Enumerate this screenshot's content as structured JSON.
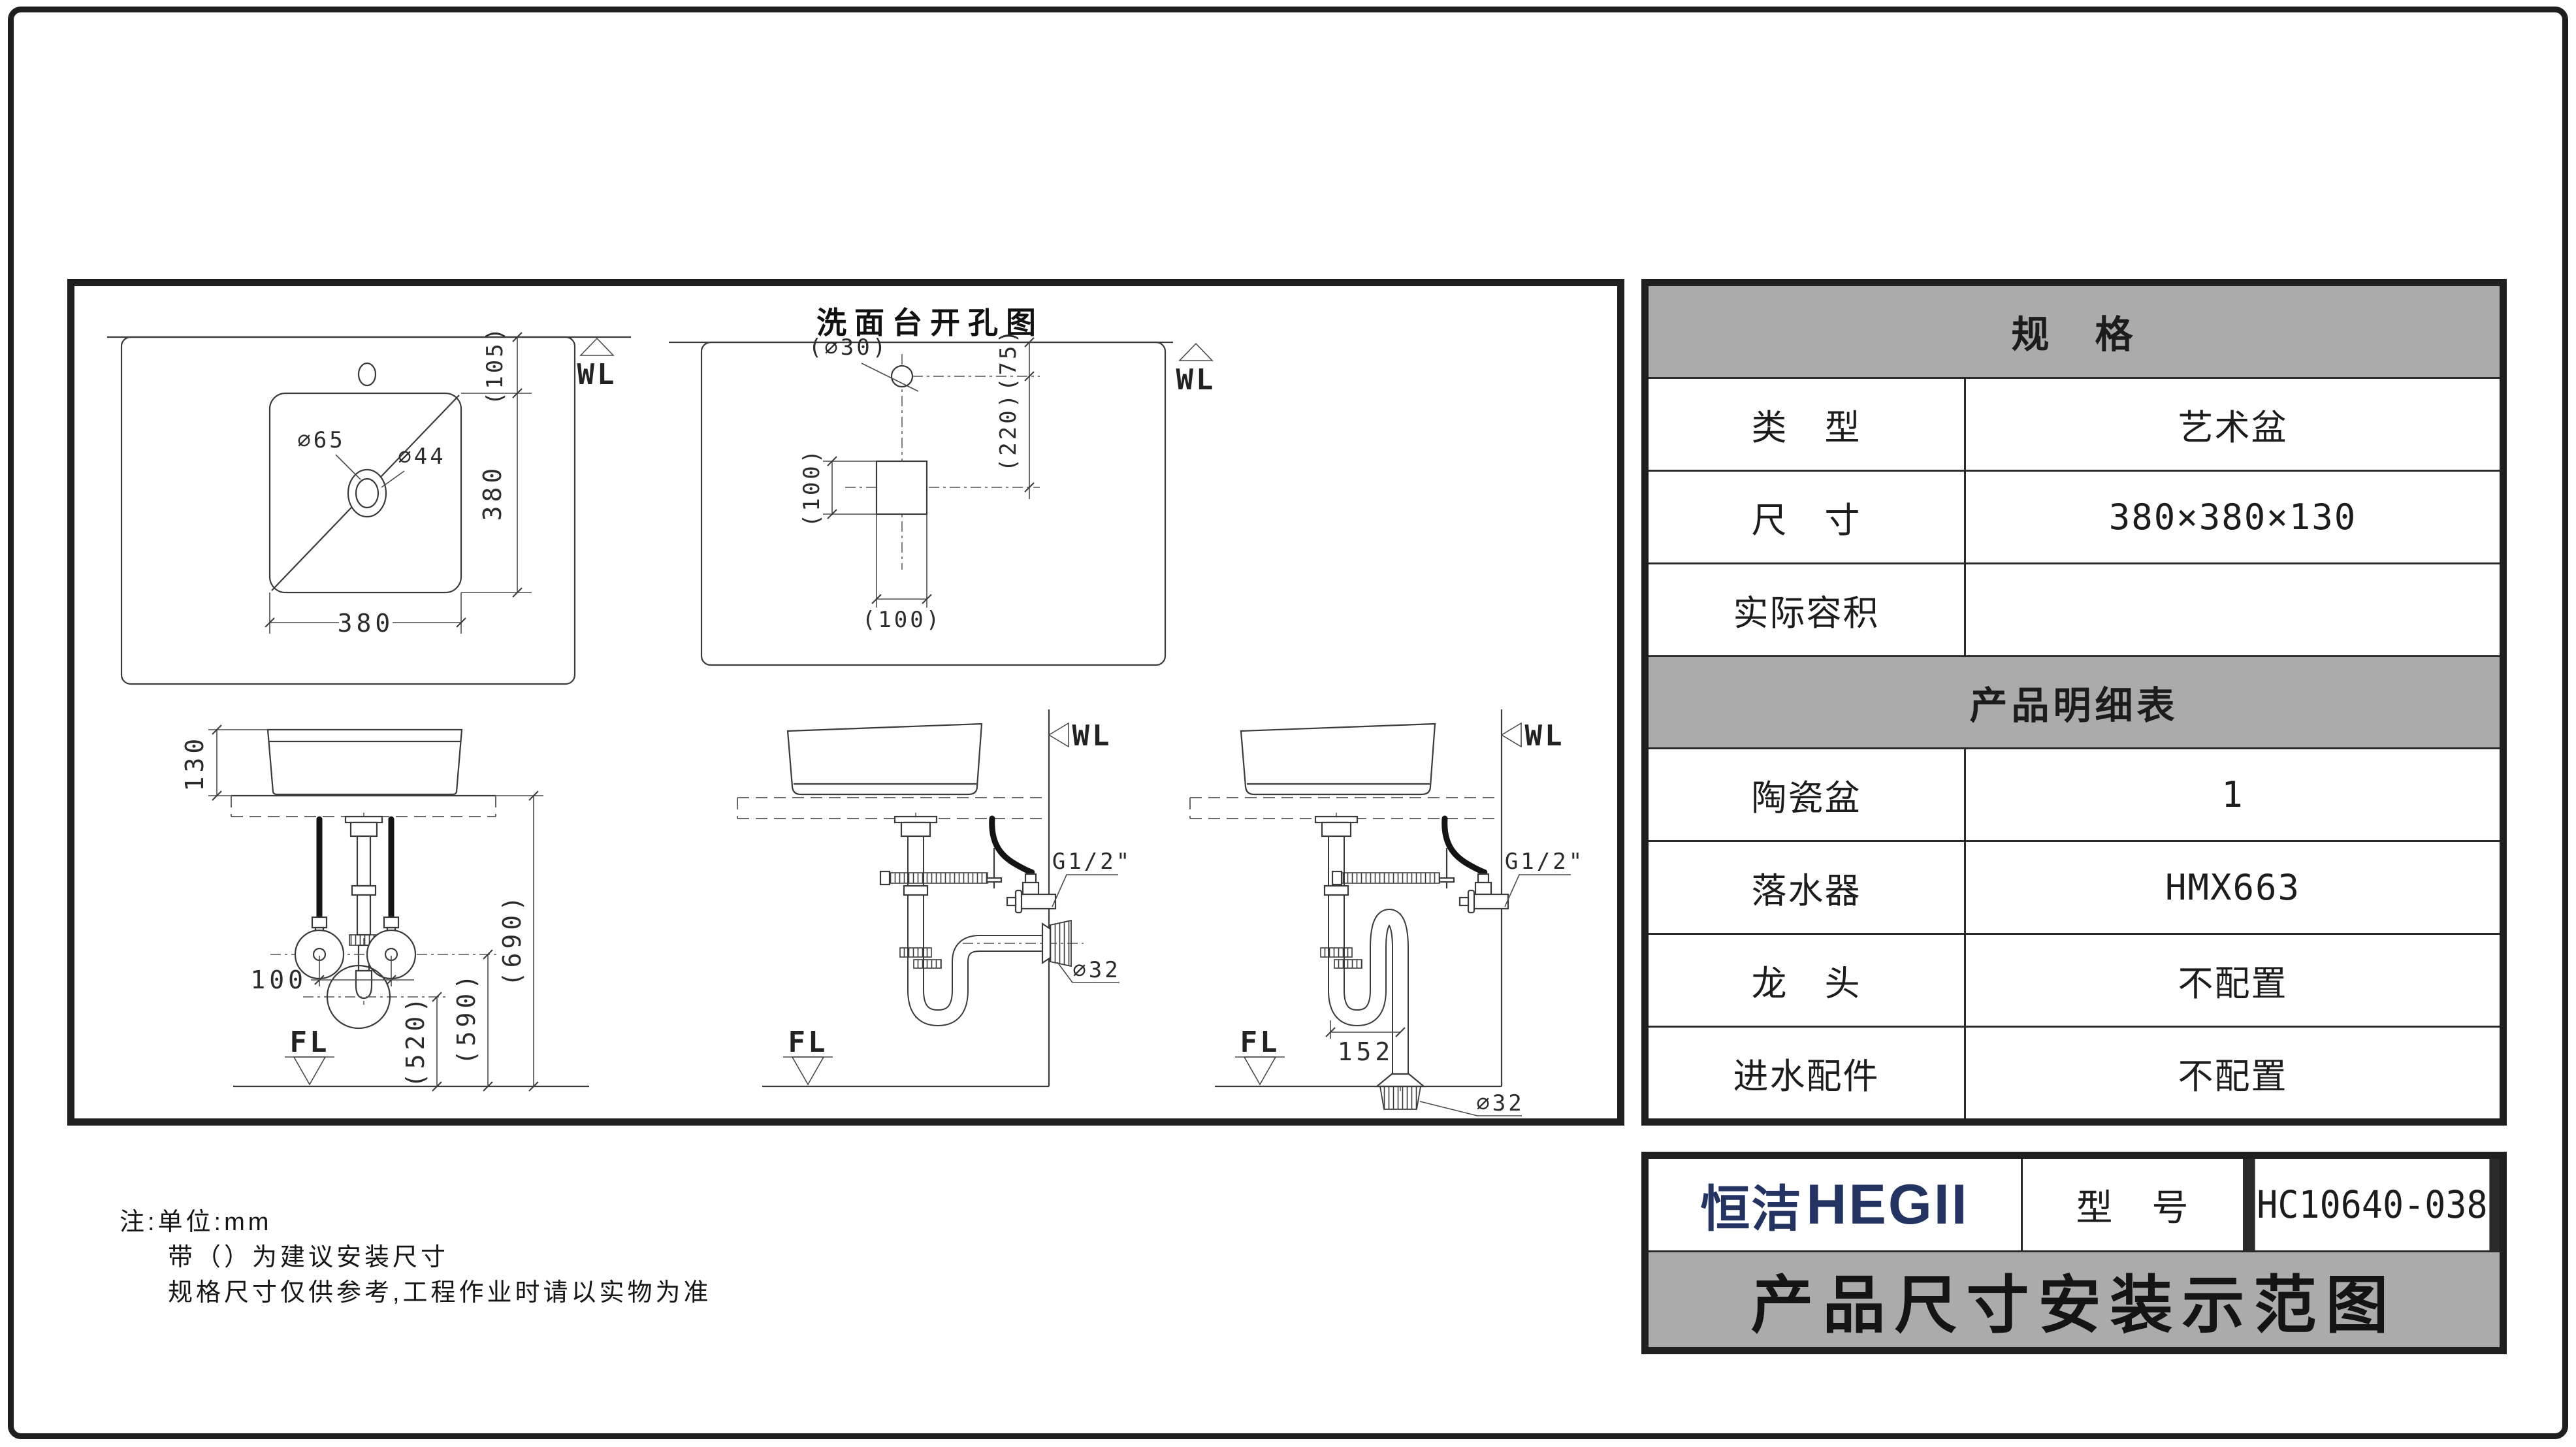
{
  "colors": {
    "brand_navy": "#233463",
    "header_gray": "#ababab",
    "line_black": "#1f1f1f"
  },
  "drawing": {
    "hole_diagram_title": "洗面台开孔图",
    "labels": {
      "wl": "WL",
      "fl": "FL",
      "g_half": "G1/2\"",
      "dia65": "∅65",
      "dia44": "∅44",
      "dia30": "(∅30)",
      "dia32": "∅32",
      "d105": "(105)",
      "d380": "380",
      "d75": "(75)",
      "d220": "(220)",
      "d100p": "(100)",
      "d130": "130",
      "d100": "100",
      "d520": "(520)",
      "d590": "(590)",
      "d690": "(690)",
      "d152": "152"
    }
  },
  "spec_table": {
    "header": "规　格",
    "rows": [
      {
        "label": "类　型",
        "value": "艺术盆"
      },
      {
        "label": "尺　寸",
        "value": "380×380×130"
      },
      {
        "label": "实际容积",
        "value": ""
      }
    ],
    "detail_header": "产品明细表",
    "detail_rows": [
      {
        "label": "陶瓷盆",
        "value": "1"
      },
      {
        "label": "落水器",
        "value": "HMX663"
      },
      {
        "label": "龙　头",
        "value": "不配置"
      },
      {
        "label": "进水配件",
        "value": "不配置"
      }
    ]
  },
  "title_block": {
    "logo_cn": "恒洁",
    "logo_en": "HEGII",
    "model_label": "型　号",
    "model_value": "HC10640-038",
    "sheet_title": "产品尺寸安装示范图"
  },
  "notes": {
    "line1": "注:单位:mm",
    "line2": "带（）为建议安装尺寸",
    "line3": "规格尺寸仅供参考,工程作业时请以实物为准"
  }
}
